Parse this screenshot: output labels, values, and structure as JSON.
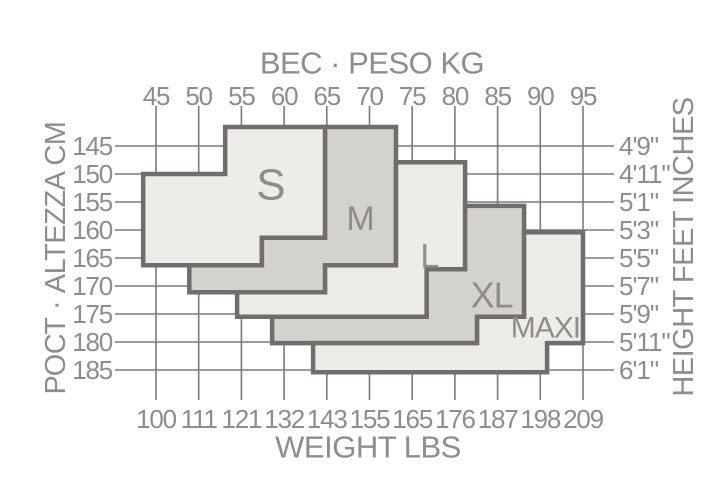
{
  "page": {
    "background": "#ffffff"
  },
  "chart_data": {
    "type": "area",
    "subtype": "stepped-size-region-chart",
    "axes": {
      "top": {
        "title": "ВЕС · PESO KG",
        "ticks": [
          45,
          50,
          55,
          60,
          65,
          70,
          75,
          80,
          85,
          90,
          95
        ],
        "range": [
          45,
          95
        ]
      },
      "bottom": {
        "title": "WEIGHT LBS",
        "ticks": [
          100,
          111,
          121,
          132,
          143,
          155,
          165,
          176,
          187,
          198,
          209
        ]
      },
      "left": {
        "title": "РОСТ · ALTEZZA CM",
        "ticks": [
          145,
          150,
          155,
          160,
          165,
          170,
          175,
          180,
          185
        ],
        "range": [
          145,
          185
        ]
      },
      "right": {
        "title": "HEIGHT FEET INCHES",
        "ticks": [
          "4'9\"",
          "4'11\"",
          "5'1\"",
          "5'3\"",
          "5'5\"",
          "5'7\"",
          "5'9\"",
          "5'11\"",
          "6'1\""
        ]
      }
    },
    "grid": true,
    "legend_position": "none",
    "colors": {
      "region_light": "#edece9",
      "region_dark": "#d4d2cf",
      "region_border": "#706d6a",
      "grid_line": "#7d7a78",
      "text": "#8f8c89"
    },
    "regions": [
      {
        "label": "S",
        "shade": "light",
        "label_anchor_kg_cm": [
          58.4,
          152.0
        ],
        "polygon_kg_cm": [
          [
            43.5,
            150.0
          ],
          [
            53.1,
            150.0
          ],
          [
            53.1,
            141.6
          ],
          [
            64.8,
            141.6
          ],
          [
            64.8,
            161.4
          ],
          [
            57.4,
            161.4
          ],
          [
            57.4,
            166.3
          ],
          [
            43.5,
            166.3
          ]
        ]
      },
      {
        "label": "M",
        "shade": "dark",
        "label_anchor_kg_cm": [
          68.9,
          158.0
        ],
        "polygon_kg_cm": [
          [
            64.8,
            141.6
          ],
          [
            73.1,
            141.6
          ],
          [
            73.1,
            166.3
          ],
          [
            64.8,
            166.3
          ],
          [
            64.8,
            171.1
          ],
          [
            48.9,
            171.1
          ],
          [
            48.9,
            166.3
          ],
          [
            57.4,
            166.3
          ],
          [
            57.4,
            161.4
          ],
          [
            64.8,
            161.4
          ]
        ]
      },
      {
        "label": "L",
        "shade": "light",
        "label_anchor_kg_cm": [
          77.0,
          164.7
        ],
        "polygon_kg_cm": [
          [
            73.1,
            147.9
          ],
          [
            81.2,
            147.9
          ],
          [
            81.2,
            167.0
          ],
          [
            76.7,
            167.0
          ],
          [
            76.7,
            175.5
          ],
          [
            54.5,
            175.5
          ],
          [
            54.5,
            171.1
          ],
          [
            64.8,
            171.1
          ],
          [
            64.8,
            166.3
          ],
          [
            73.1,
            166.3
          ]
        ]
      },
      {
        "label": "XL",
        "shade": "dark",
        "label_anchor_kg_cm": [
          84.3,
          171.6
        ],
        "polygon_kg_cm": [
          [
            81.2,
            155.7
          ],
          [
            88.1,
            155.7
          ],
          [
            88.1,
            175.5
          ],
          [
            82.6,
            175.5
          ],
          [
            82.6,
            180.2
          ],
          [
            58.6,
            180.2
          ],
          [
            58.6,
            175.5
          ],
          [
            76.7,
            175.5
          ],
          [
            76.7,
            167.0
          ],
          [
            81.2,
            167.0
          ]
        ]
      },
      {
        "label": "MAXI",
        "shade": "light",
        "label_anchor_kg_cm": [
          90.6,
          177.5
        ],
        "polygon_kg_cm": [
          [
            88.1,
            160.4
          ],
          [
            95.0,
            160.4
          ],
          [
            95.0,
            180.2
          ],
          [
            90.8,
            180.2
          ],
          [
            90.8,
            185.4
          ],
          [
            63.4,
            185.4
          ],
          [
            63.4,
            180.2
          ],
          [
            82.6,
            180.2
          ],
          [
            82.6,
            175.5
          ],
          [
            88.1,
            175.5
          ]
        ]
      }
    ]
  }
}
